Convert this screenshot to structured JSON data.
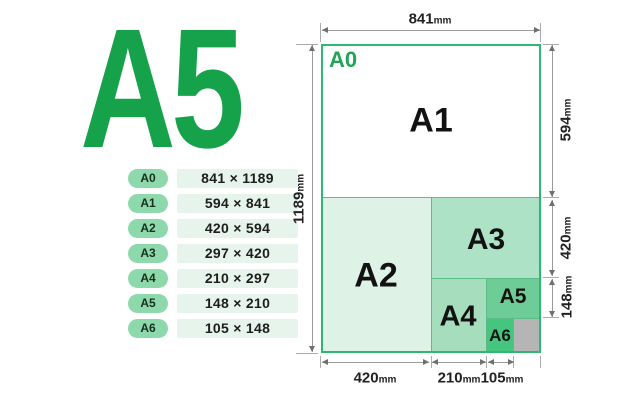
{
  "theme": {
    "pill-bg": "#8ed9ab",
    "value-bg": "#e6f4eb",
    "hero-green": "#16a24a",
    "sheet-border": "#2eb871",
    "sep-green": "#5dbd8a",
    "line-gray": "#9b9b9b",
    "arrow-gray": "#6f6f6f",
    "text-dark": "#1d1d1d"
  },
  "hero": {
    "label": "A5",
    "color": "#16a24a"
  },
  "size_table": {
    "rows": [
      {
        "name": "A0",
        "dims": "841 × 1189"
      },
      {
        "name": "A1",
        "dims": "594 × 841"
      },
      {
        "name": "A2",
        "dims": "420 × 594"
      },
      {
        "name": "A3",
        "dims": "297 × 420"
      },
      {
        "name": "A4",
        "dims": "210 × 297"
      },
      {
        "name": "A5",
        "dims": "148 × 210"
      },
      {
        "name": "A6",
        "dims": "105 × 148"
      }
    ]
  },
  "diagram": {
    "sheet_label": "A0",
    "sheet_label_color": "#21a457",
    "border_color": "#2eb871",
    "regions": [
      {
        "label": "A1",
        "fill": "#ffffff"
      },
      {
        "label": "A2",
        "fill": "#def2e6"
      },
      {
        "label": "A3",
        "fill": "#aee2c6"
      },
      {
        "label": "A4",
        "fill": "#a5ddbd"
      },
      {
        "label": "A5",
        "fill": "#6ecc96"
      },
      {
        "label": "A6",
        "fill": "#46c57e"
      }
    ],
    "remainder": {
      "fill": "#b5b5b5"
    },
    "dims": {
      "top": {
        "value": "841",
        "unit": "mm"
      },
      "left": {
        "value": "1189",
        "unit": "mm"
      },
      "right": [
        {
          "value": "594",
          "unit": "mm"
        },
        {
          "value": "420",
          "unit": "mm"
        },
        {
          "value": "148",
          "unit": "mm"
        }
      ],
      "bottom": [
        {
          "value": "420",
          "unit": "mm"
        },
        {
          "value": "210",
          "unit": "mm"
        },
        {
          "value": "105",
          "unit": "mm"
        }
      ]
    }
  }
}
